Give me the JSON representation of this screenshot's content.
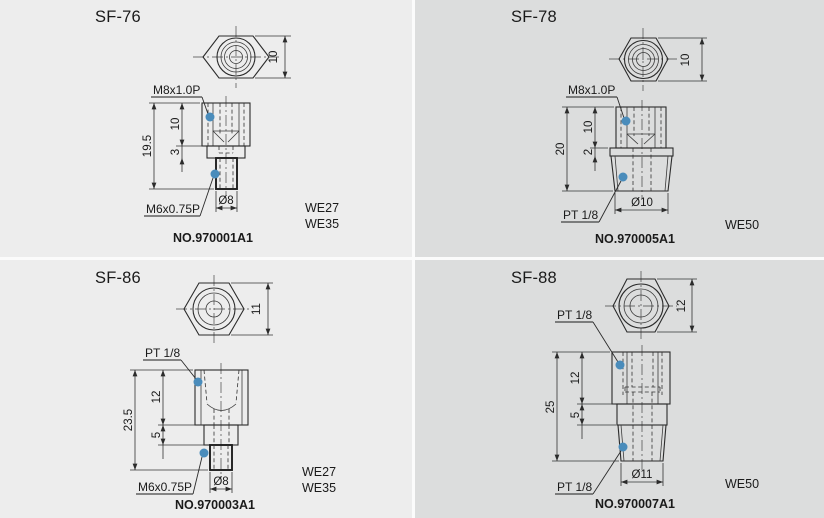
{
  "style": {
    "bg_left": "#ededed",
    "bg_right": "#dcdddd",
    "divider": "#fbfbfb",
    "line_color": "#2b2b2b",
    "accent_dot_color": "#4a8cbb"
  },
  "panels": [
    {
      "title": "SF-76",
      "part_no": "NO.970001A1",
      "wrench_sizes": [
        "WE27",
        "WE35"
      ],
      "top_view": {
        "height_dim": "10"
      },
      "side_view": {
        "overall_dim": "19.5",
        "upper_dim": "10",
        "mid_dim": "3",
        "diameter_dim": "Ø8",
        "upper_thread_label": "M8x1.0P",
        "lower_thread_label": "M6x0.75P"
      }
    },
    {
      "title": "SF-78",
      "part_no": "NO.970005A1",
      "wrench_sizes": [
        "WE50"
      ],
      "top_view": {
        "height_dim": "10"
      },
      "side_view": {
        "overall_dim": "20",
        "upper_dim": "10",
        "mid_dim": "2",
        "diameter_dim": "Ø10",
        "upper_thread_label": "M8x1.0P",
        "lower_thread_label": "PT 1/8"
      }
    },
    {
      "title": "SF-86",
      "part_no": "NO.970003A1",
      "wrench_sizes": [
        "WE27",
        "WE35"
      ],
      "top_view": {
        "height_dim": "11"
      },
      "side_view": {
        "overall_dim": "23.5",
        "upper_dim": "12",
        "mid_dim": "5",
        "diameter_dim": "Ø8",
        "upper_thread_label": "PT 1/8",
        "lower_thread_label": "M6x0.75P"
      }
    },
    {
      "title": "SF-88",
      "part_no": "NO.970007A1",
      "wrench_sizes": [
        "WE50"
      ],
      "top_view": {
        "height_dim": "12"
      },
      "side_view": {
        "overall_dim": "25",
        "upper_dim": "12",
        "mid_dim": "5",
        "diameter_dim": "Ø11",
        "upper_thread_label": "PT 1/8",
        "lower_thread_label": "PT 1/8"
      }
    }
  ]
}
